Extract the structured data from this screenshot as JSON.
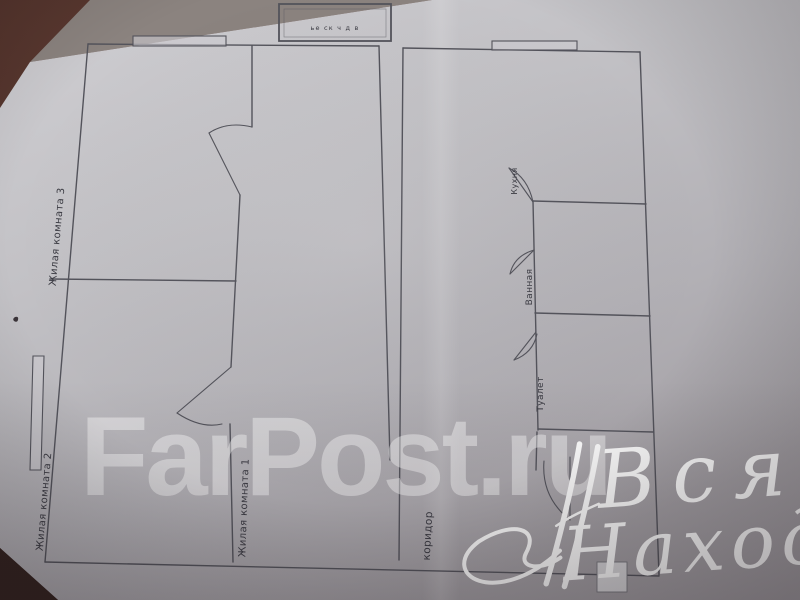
{
  "floor_plan": {
    "title_block_text": "ье ск ч д в",
    "room_labels": {
      "room3": "Жилая комната 3",
      "room2": "Жилая комната 2",
      "room1": "Жилая комната 1",
      "kitchen": "Кухня",
      "bathroom": "Ванная",
      "toilet": "Туалет",
      "corridor": "коридор"
    }
  },
  "watermarks": {
    "farpost": "FarPost.ru",
    "script_line1": "Вся",
    "script_line2": "Находка"
  },
  "colors": {
    "table": "#4f2f2a",
    "paper": "#c0bfc3",
    "plan_line": "#53535b",
    "label_ink": "#3a3a42",
    "watermark": "#ffffff"
  }
}
